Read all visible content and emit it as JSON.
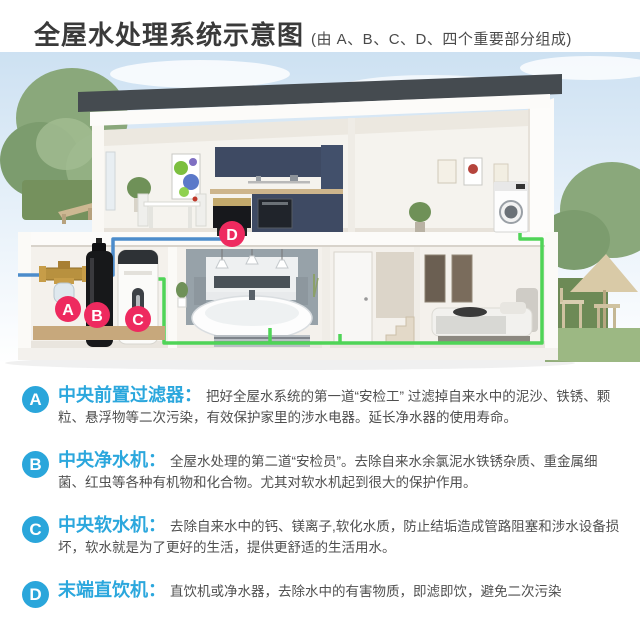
{
  "colors": {
    "section_blue": "#2aa6db",
    "marker_pink": "#ee2a5f",
    "pipe_blue": "#4c8ccb",
    "pipe_green": "#4fd457",
    "roof_dark": "#454b50",
    "cabinet_navy": "#3e4a63"
  },
  "header": {
    "title": "全屋水处理系统示意图",
    "subtitle": "(由 A、B、C、D、四个重要部分组成)"
  },
  "diagram": {
    "markers": {
      "a": "A",
      "b": "B",
      "c": "C",
      "d": "D"
    }
  },
  "sections": [
    {
      "letter": "A",
      "heading": "中央前置过滤器：",
      "body": "把好全屋水系统的第一道“安检工” 过滤掉自来水中的泥沙、铁锈、颗粒、悬浮物等二次污染，有效保护家里的涉水电器。延长净水器的使用寿命。"
    },
    {
      "letter": "B",
      "heading": "中央净水机：",
      "body": "全屋水处理的第二道“安检员”。去除自来水余氯泥水铁锈杂质、重金属细菌、红虫等各种有机物和化合物。尤其对软水机起到很大的保护作用。"
    },
    {
      "letter": "C",
      "heading": "中央软水机：",
      "body": "去除自来水中的钙、镁离子,软化水质，防止结垢造成管路阻塞和涉水设备损坏，软水就是为了更好的生活，提供更舒适的生活用水。"
    },
    {
      "letter": "D",
      "heading": "末端直饮机：",
      "body": "直饮机或净水器，去除水中的有害物质，即滤即饮，避免二次污染"
    }
  ]
}
